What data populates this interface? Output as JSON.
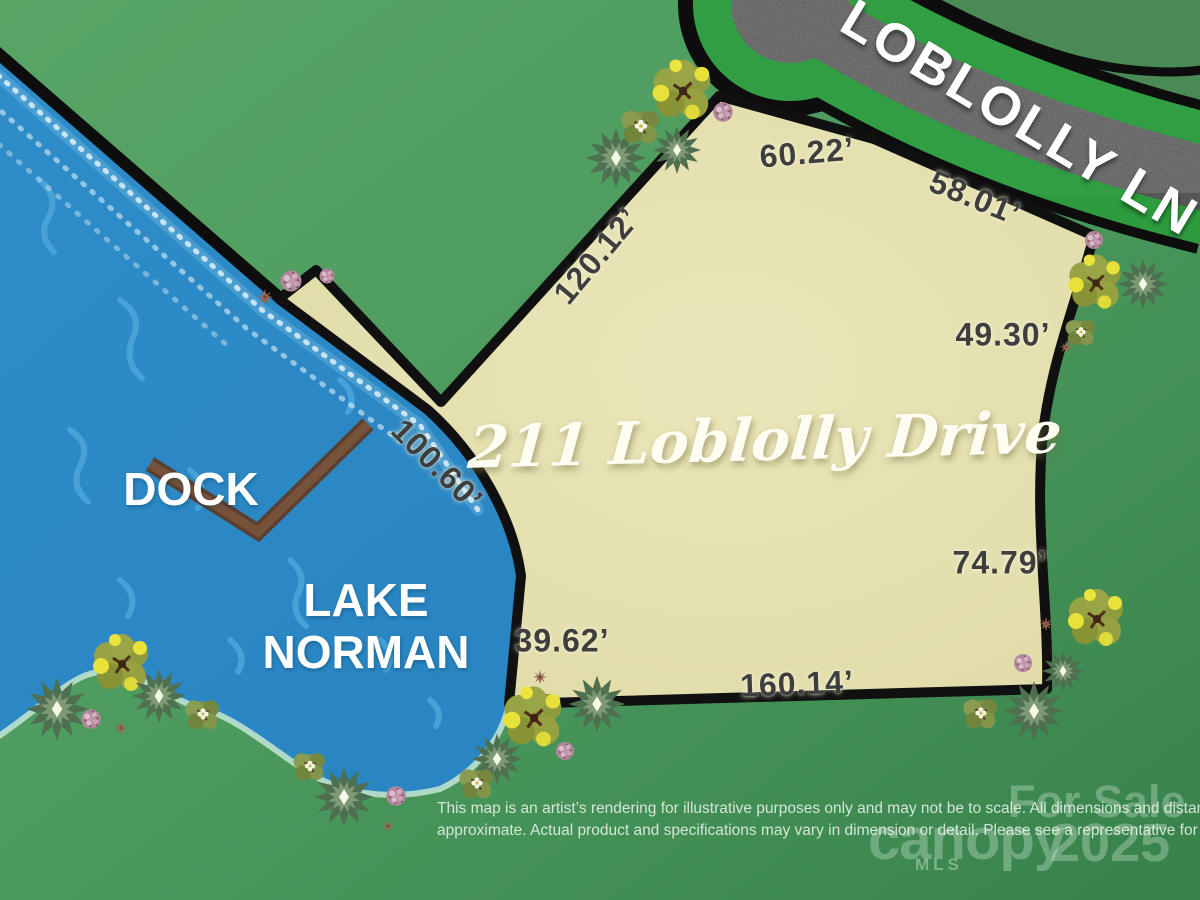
{
  "map_title": "211 Loblolly Drive",
  "road_name": "LOBLOLLY LN",
  "lake_name": {
    "line1": "LAKE",
    "line2": "NORMAN"
  },
  "dock_label": "DOCK",
  "lot_dimensions": [
    {
      "edge": "road-frontage-west",
      "text": "60.22’"
    },
    {
      "edge": "road-frontage-east",
      "text": "58.01’"
    },
    {
      "edge": "northwest-side",
      "text": "120.12’"
    },
    {
      "edge": "east-upper-side",
      "text": "49.30’"
    },
    {
      "edge": "waterfront-side",
      "text": "100.60’"
    },
    {
      "edge": "east-lower-side",
      "text": "74.79’"
    },
    {
      "edge": "southwest-side",
      "text": "39.62’"
    },
    {
      "edge": "south-side",
      "text": "160.14’"
    }
  ],
  "disclaimer": {
    "line1": "This map is an artist’s rendering for illustrative purposes only and may not be to scale. All dimensions and distances are",
    "line2": "approximate. Actual product and specifications may vary in dimension or detail. Please see a representative for details."
  },
  "watermark": {
    "status": "For Sale",
    "brand": "canopy",
    "brand_sub": "MLS",
    "year": "2025"
  },
  "colors": {
    "grass": "#4f9c5e",
    "grass_dark_lot": "#4a8a56",
    "water": "#2e8dc9",
    "water_ripple": "#4da6da",
    "parcel": "#e6e2ae",
    "outline": "#0d0d0d",
    "road_asphalt": "#575757",
    "road_verge": "#2d9c3e",
    "dock": "#5f432f",
    "dimension_text": "#3e3e3e",
    "label_text": "#ffffff"
  }
}
